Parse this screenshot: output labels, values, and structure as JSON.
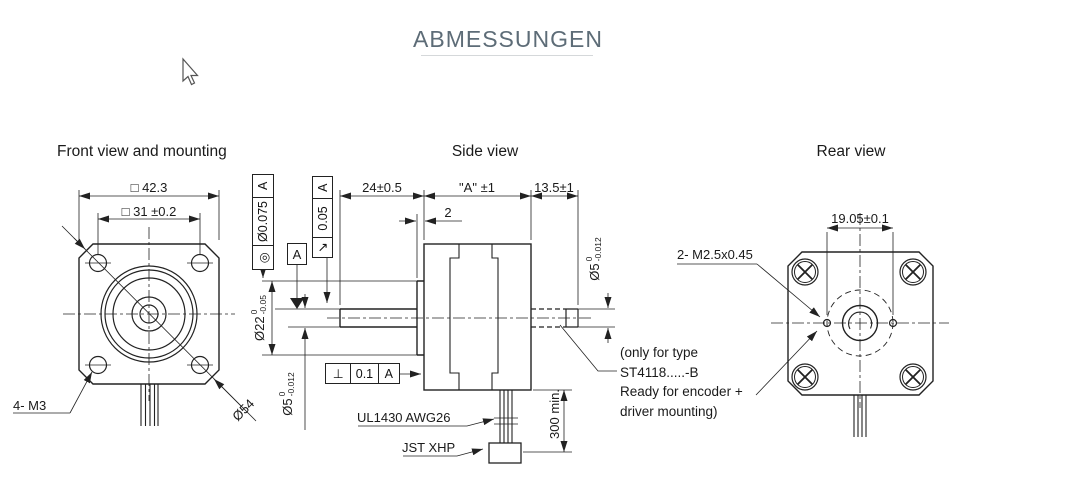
{
  "header": {
    "title": "ABMESSUNGEN"
  },
  "front": {
    "title": "Front view and mounting",
    "dim_outer_square": "□ 42.3",
    "dim_bolt_spacing": "□ 31 ±0.2",
    "label_mount_holes": "4- M3",
    "dim_diagonal": "Ø54"
  },
  "side": {
    "title": "Side view",
    "dim_shaft_length": "24±0.5",
    "dim_body_length": "\"A\" ±1",
    "dim_rear_shaft_length": "13.5±1",
    "dim_pilot_depth": "2",
    "pilot": {
      "nominal": "Ø22",
      "upper": "0",
      "lower": "-0.05"
    },
    "shaft_front": {
      "nominal": "Ø5",
      "upper": "0",
      "lower": "-0.012"
    },
    "shaft_rear": {
      "nominal": "Ø5",
      "upper": "0",
      "lower": "-0.012"
    },
    "gdt_concentricity": {
      "symbol": "◎",
      "value": "Ø0.075",
      "datum": "A"
    },
    "gdt_runout": {
      "symbol": "↗",
      "value": "0.05",
      "datum": "A"
    },
    "gdt_perpendicularity": {
      "symbol": "⊥",
      "value": "0.1",
      "datum": "A"
    },
    "datum_label": "A",
    "label_cable": "UL1430  AWG26",
    "label_connector": "JST XHP",
    "dim_cable_length": "300 min."
  },
  "rear": {
    "title": "Rear view",
    "dim_hole_spacing": "19.05±0.1",
    "label_tapped_holes": "2- M2.5x0.45",
    "note_1": "(only for type",
    "note_2": "ST4118.....-B",
    "note_3": "Ready for encoder +",
    "note_4": "driver mounting)"
  },
  "colors": {
    "line": "#222222",
    "title": "#5d6c77"
  }
}
